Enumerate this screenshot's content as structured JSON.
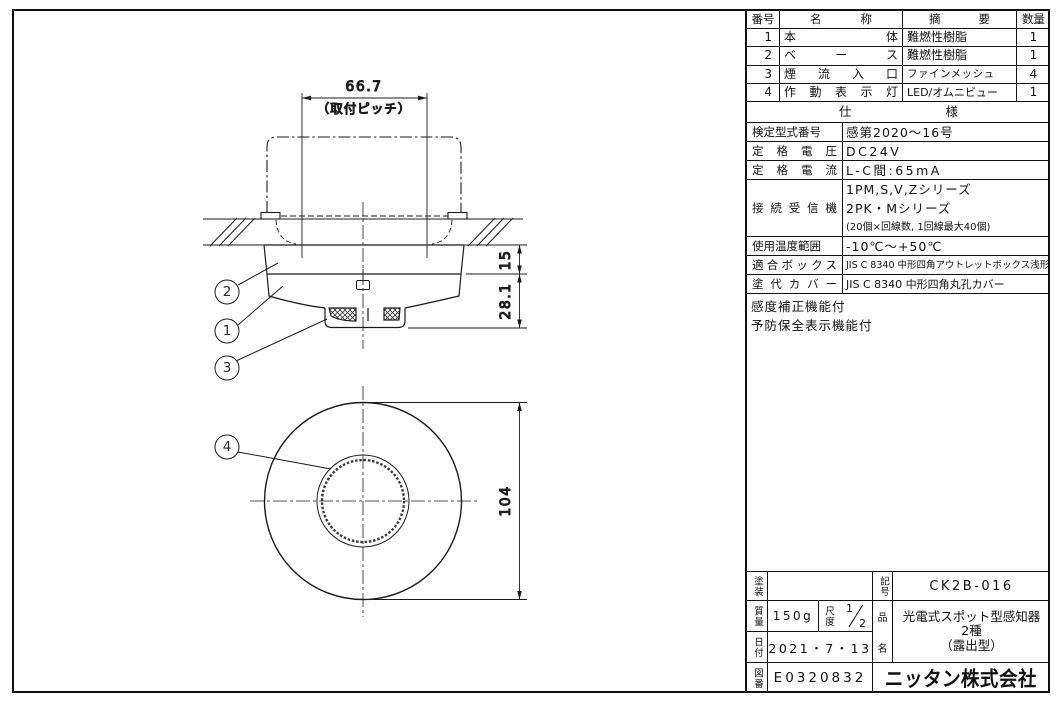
{
  "sheet": {
    "ink": "#1a1a1a",
    "paper": "#ffffff"
  },
  "drawing": {
    "dim_pitch": "66.7",
    "dim_pitch_note": "（取付ピッチ）",
    "dim_base_height": "15",
    "dim_total_height": "28.1",
    "dim_diameter": "104",
    "balloon_1": "1",
    "balloon_2": "2",
    "balloon_3": "3",
    "balloon_4": "4"
  },
  "parts_table": {
    "headers": {
      "no": "番号",
      "name": "名称",
      "desc": "摘要",
      "qty": "数量"
    },
    "rows": [
      {
        "no": "1",
        "name": "本体",
        "desc": "難燃性樹脂",
        "qty": "1"
      },
      {
        "no": "2",
        "name": "ベース",
        "desc": "難燃性樹脂",
        "qty": "1"
      },
      {
        "no": "3",
        "name": "煙流入口",
        "desc": "ファインメッシュ",
        "qty": "4"
      },
      {
        "no": "4",
        "name": "作動表示灯",
        "desc": "LED/オムニビュー",
        "qty": "1"
      }
    ]
  },
  "spec": {
    "title": "仕様",
    "rows": [
      {
        "label": "検定型式番号",
        "value": "感第2020〜16号"
      },
      {
        "label": "定格電圧",
        "value": "DC24V"
      },
      {
        "label": "定格電流",
        "value": "L-C間:65mA"
      },
      {
        "label": "接続受信機",
        "value1": "1PM,S,V,Zシリーズ",
        "value2": "2PK・Mシリーズ",
        "value3": "(20個×回線数, 1回線最大40個)"
      },
      {
        "label": "使用温度範囲",
        "value": "-10℃〜+50℃"
      },
      {
        "label": "適合ボックス",
        "value": "JIS C 8340 中形四角アウトレットボックス浅形"
      },
      {
        "label": "塗代カバー",
        "value": "JIS C 8340 中形四角丸孔カバー"
      }
    ],
    "notes": [
      "感度補正機能付",
      "予防保全表示機能付"
    ]
  },
  "title_block": {
    "paint_label": "塗装",
    "paint_value": "",
    "symbol_label": "記号",
    "symbol_value": "CK2B-016",
    "mass_label": "質量",
    "mass_value": "150g",
    "scale_label": "尺度",
    "scale_num": "1",
    "scale_den": "2",
    "product_label_top": "品",
    "product_label_bottom": "名",
    "product_line1": "光電式スポット型感知器",
    "product_line2": "2種",
    "product_line3": "（露出型）",
    "date_label": "日付",
    "date_value": "2021・7・13",
    "dwg_no_label": "図番",
    "dwg_no_value": "E0320832",
    "company": "ニッタン株式会社"
  }
}
